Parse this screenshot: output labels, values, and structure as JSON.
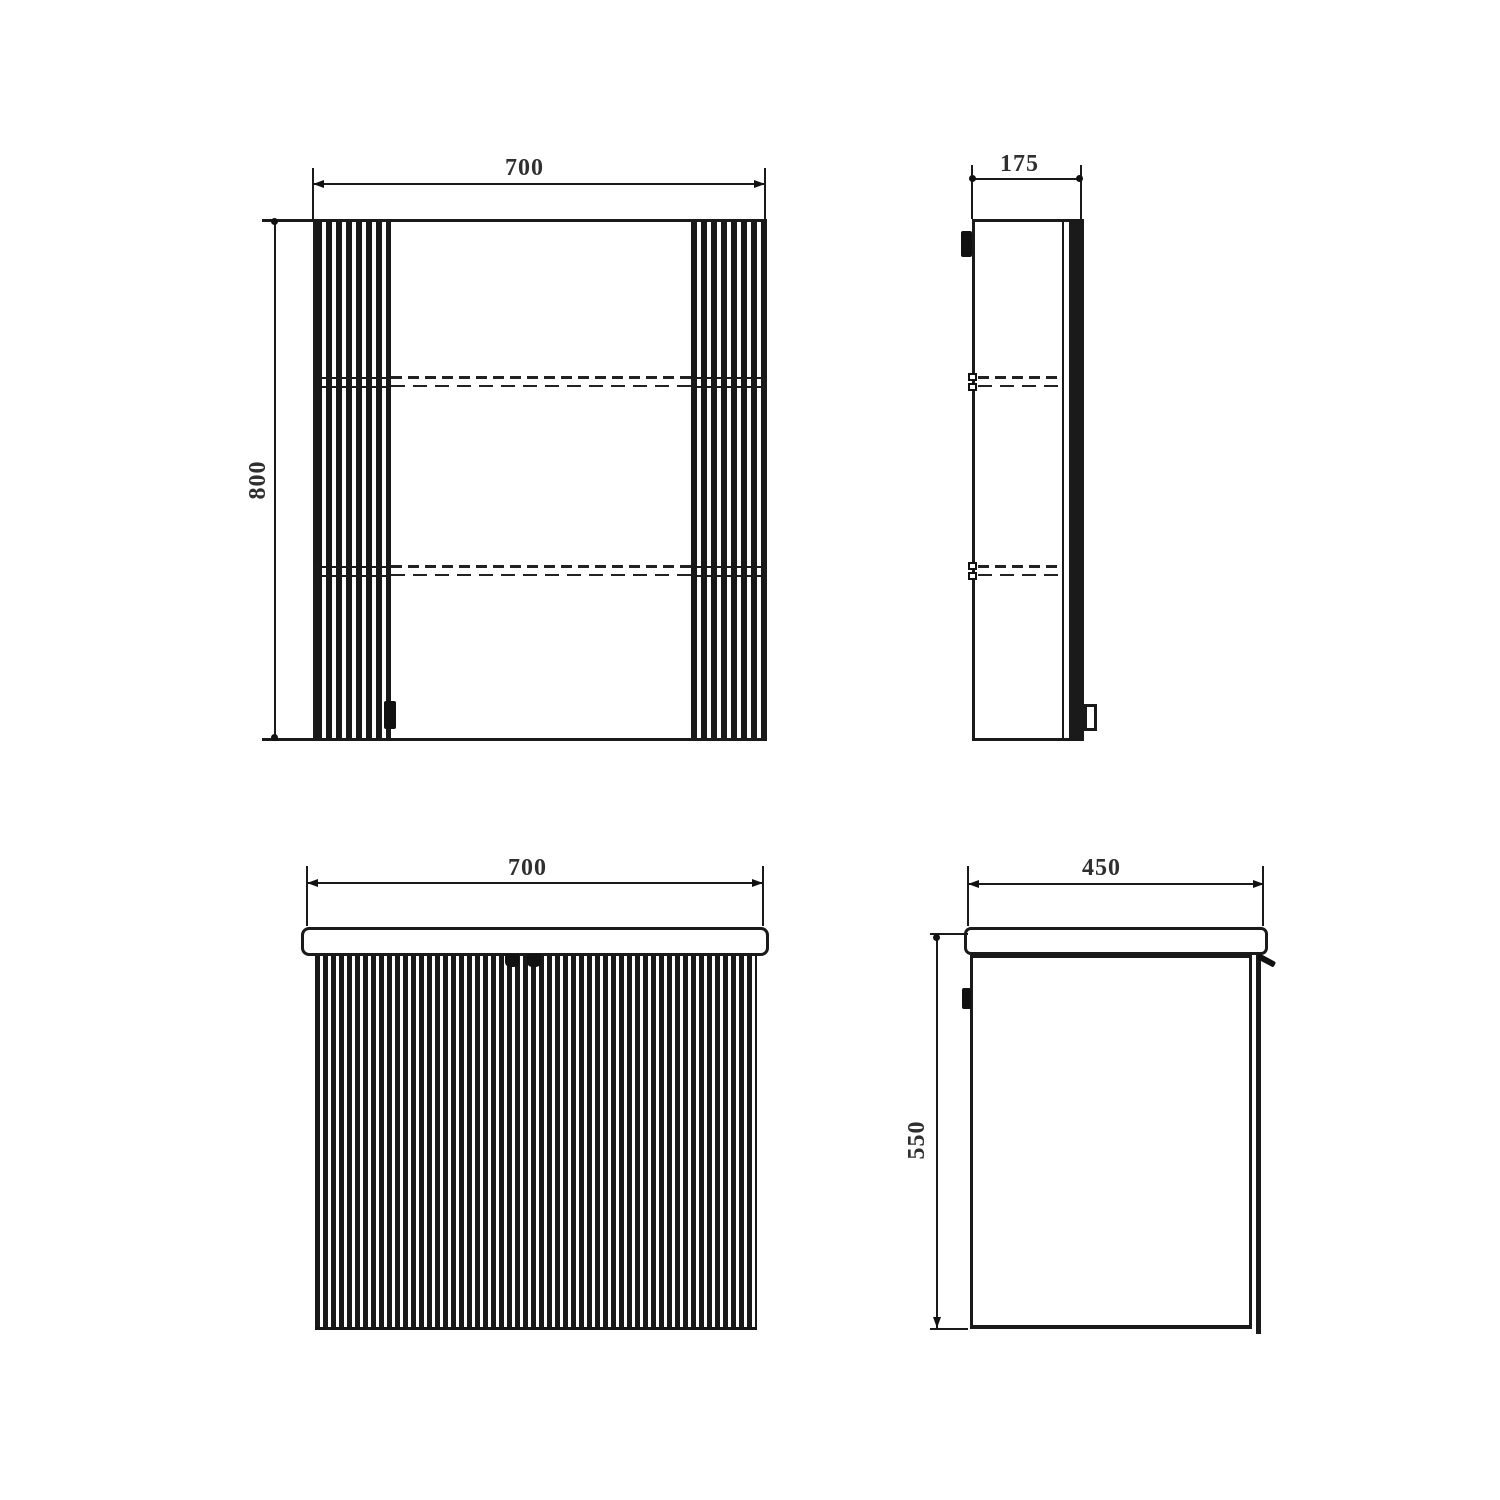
{
  "drawing": {
    "type": "technical-dimension-drawing",
    "subject": "bathroom mirror cabinet and fluted vanity unit, four orthographic views",
    "colors": {
      "line": "#1a1a1a",
      "text": "#2f2f2f",
      "background": "#ffffff"
    }
  },
  "dims": {
    "mirror_front_width": "700",
    "mirror_front_height": "800",
    "mirror_side_depth": "175",
    "vanity_front_width": "700",
    "vanity_side_depth": "450",
    "vanity_side_height": "550"
  }
}
